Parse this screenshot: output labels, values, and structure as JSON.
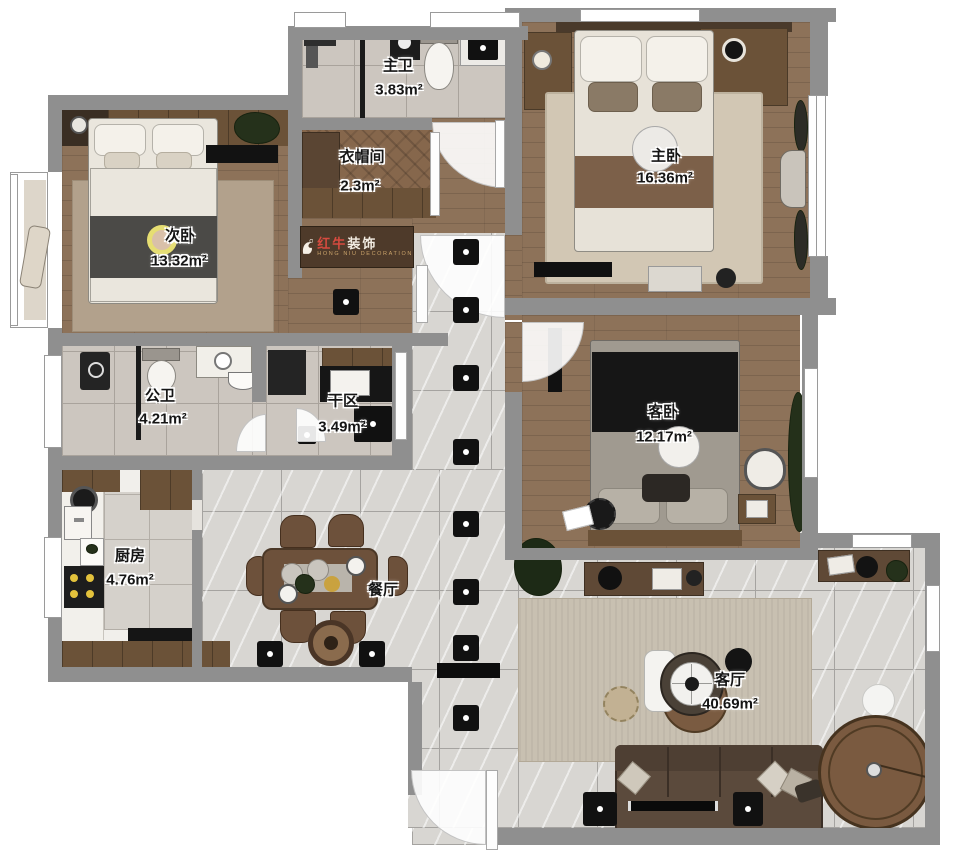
{
  "logo": {
    "brand_red": "红牛",
    "brand_white": "装饰",
    "sub": "HONG NIU DECORATION"
  },
  "rooms": {
    "master_bath": {
      "name": "主卫",
      "area": "3.83m²"
    },
    "cloakroom": {
      "name": "衣帽间",
      "area": "2.3m²"
    },
    "master_bedroom": {
      "name": "主卧",
      "area": "16.36m²"
    },
    "second_bedroom": {
      "name": "次卧",
      "area": "13.32m²"
    },
    "public_bath": {
      "name": "公卫",
      "area": "4.21m²"
    },
    "dry_area": {
      "name": "干区",
      "area": "3.49m²"
    },
    "guest_bedroom": {
      "name": "客卧",
      "area": "12.17m²"
    },
    "kitchen": {
      "name": "厨房",
      "area": "4.76m²"
    },
    "dining": {
      "name": "餐厅"
    },
    "living": {
      "name": "客厅",
      "area": "40.69m²"
    }
  }
}
